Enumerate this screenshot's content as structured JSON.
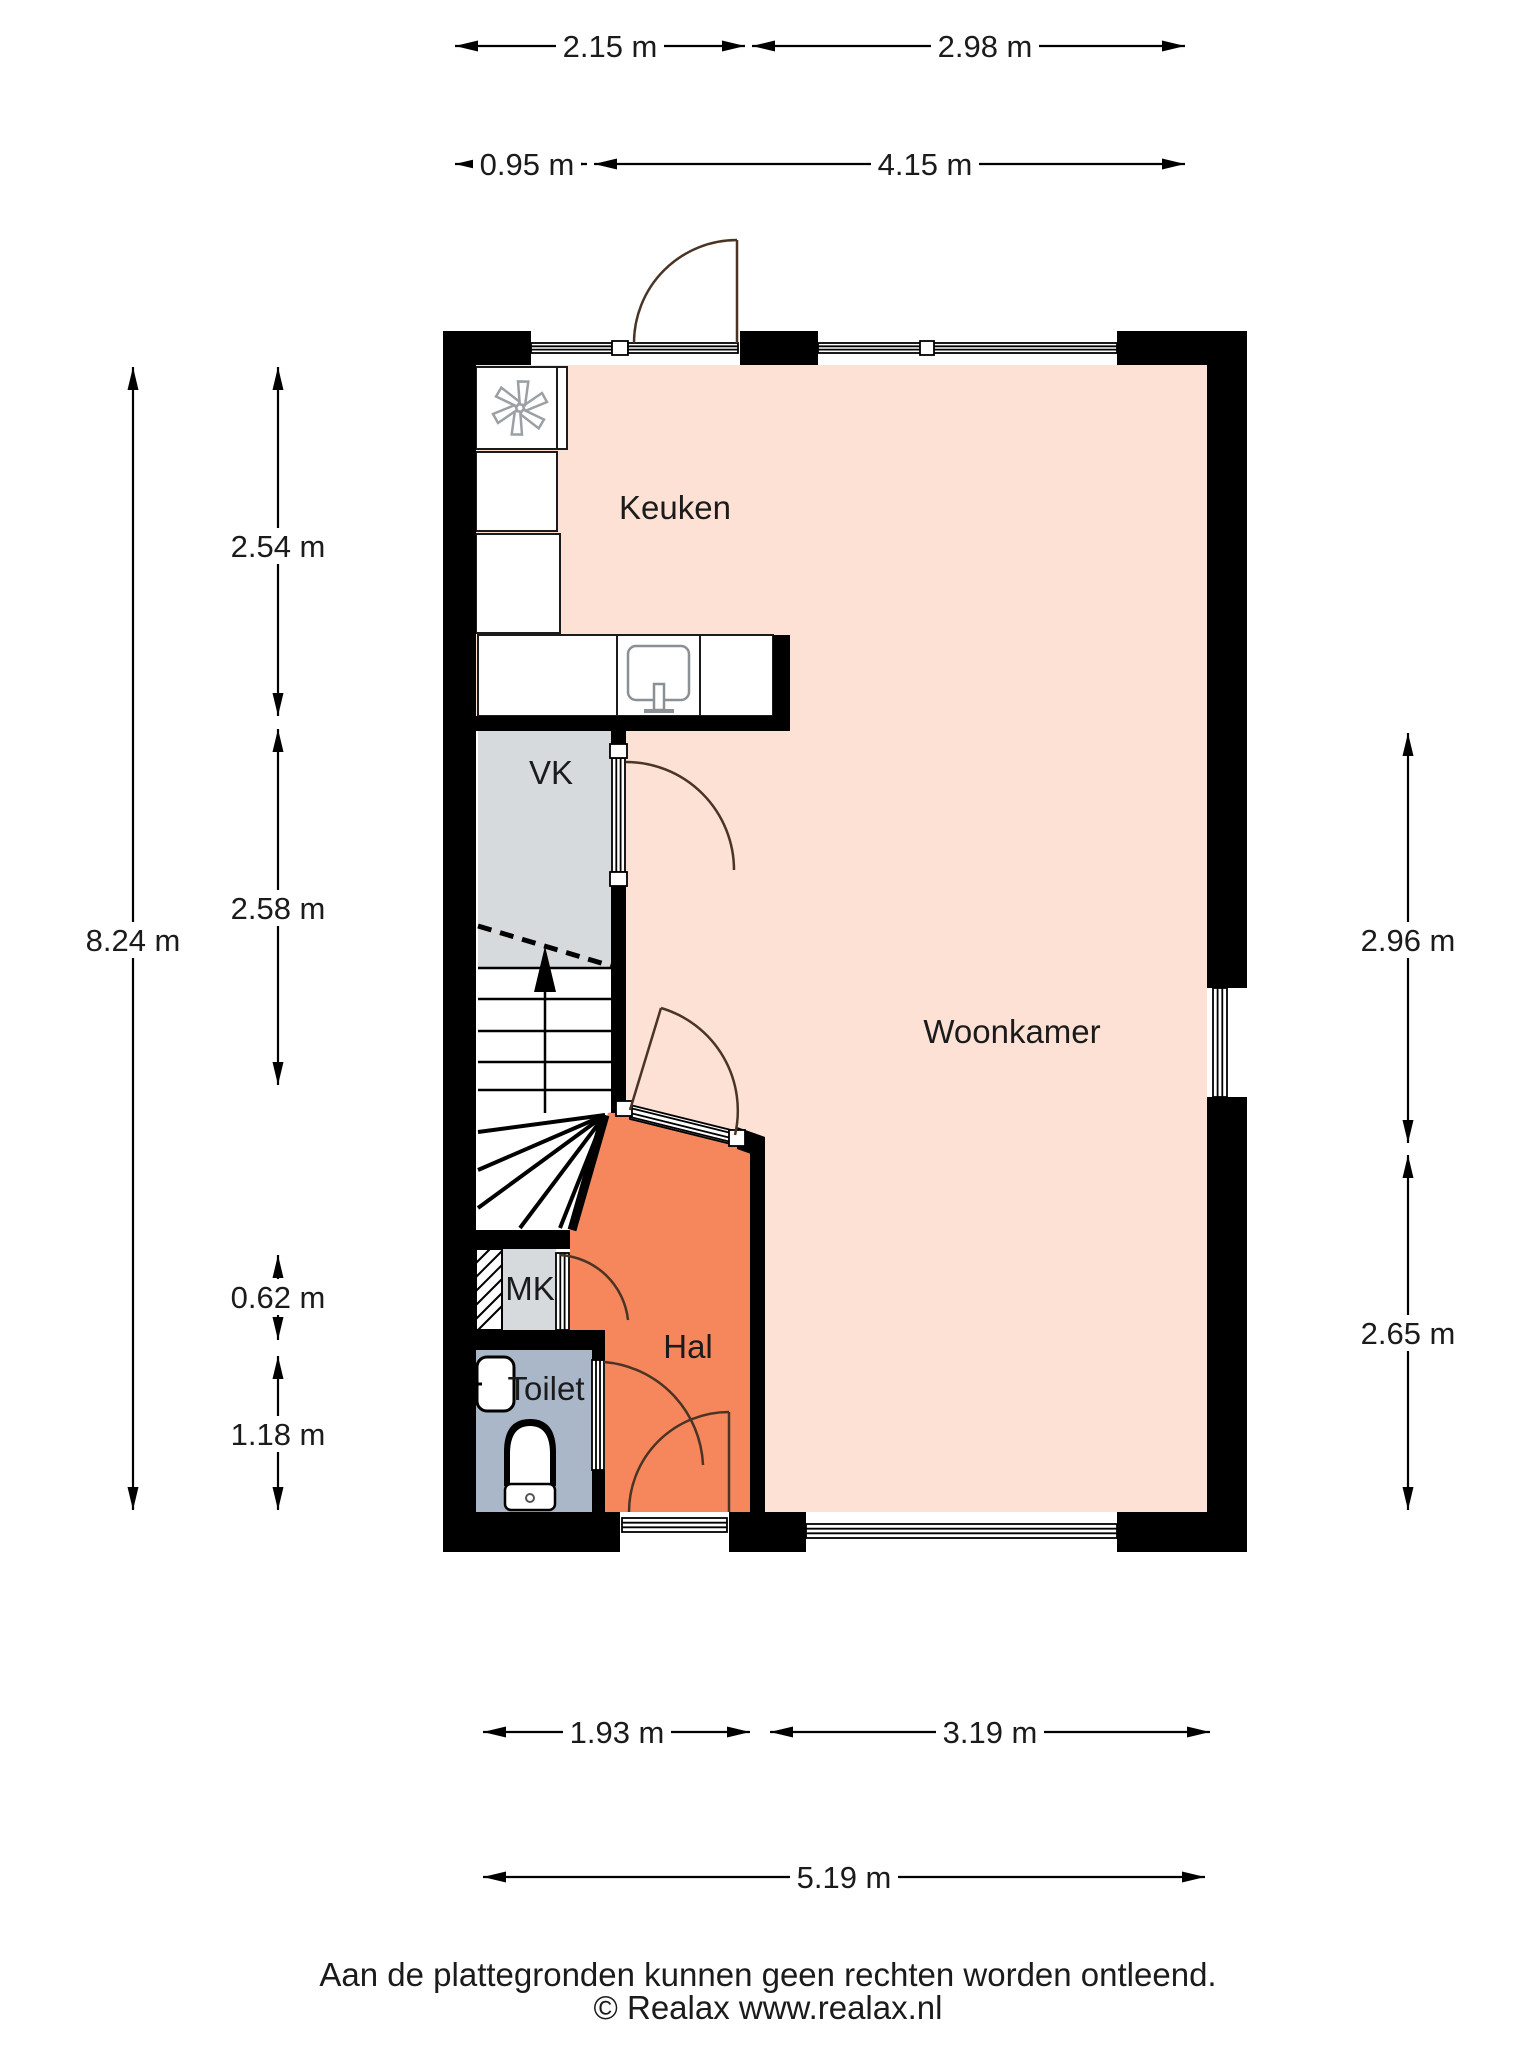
{
  "floorplan": {
    "rooms": {
      "keuken": {
        "label": "Keuken",
        "color": "#fce1d4"
      },
      "woonkamer": {
        "label": "Woonkamer",
        "color": "#fce1d4"
      },
      "vk": {
        "label": "VK",
        "color": "#d6dadd"
      },
      "mk": {
        "label": "MK",
        "color": "#d6dadd"
      },
      "hal": {
        "label": "Hal",
        "color": "#f6865c"
      },
      "toilet": {
        "label": "Toilet",
        "color": "#a9b7c9"
      }
    },
    "dimensions": {
      "top_row1": [
        "2.15 m",
        "2.98 m"
      ],
      "top_row2": [
        "0.95 m",
        "4.15 m"
      ],
      "left_outer": "8.24 m",
      "left_inner": [
        "2.54 m",
        "2.58 m",
        "0.62 m",
        "1.18 m"
      ],
      "right": [
        "2.96 m",
        "2.65 m"
      ],
      "bottom_row1": [
        "1.93 m",
        "3.19 m"
      ],
      "bottom_row2": "5.19 m"
    },
    "footer": {
      "disclaimer": "Aan de plattegronden kunnen geen rechten worden ontleend.",
      "copyright": "© Realax www.realax.nl"
    },
    "colors": {
      "wall": "#000000",
      "dimension": "#000000",
      "door_arc": "#4a3425",
      "fixture_line": "#9aa0a4"
    }
  }
}
